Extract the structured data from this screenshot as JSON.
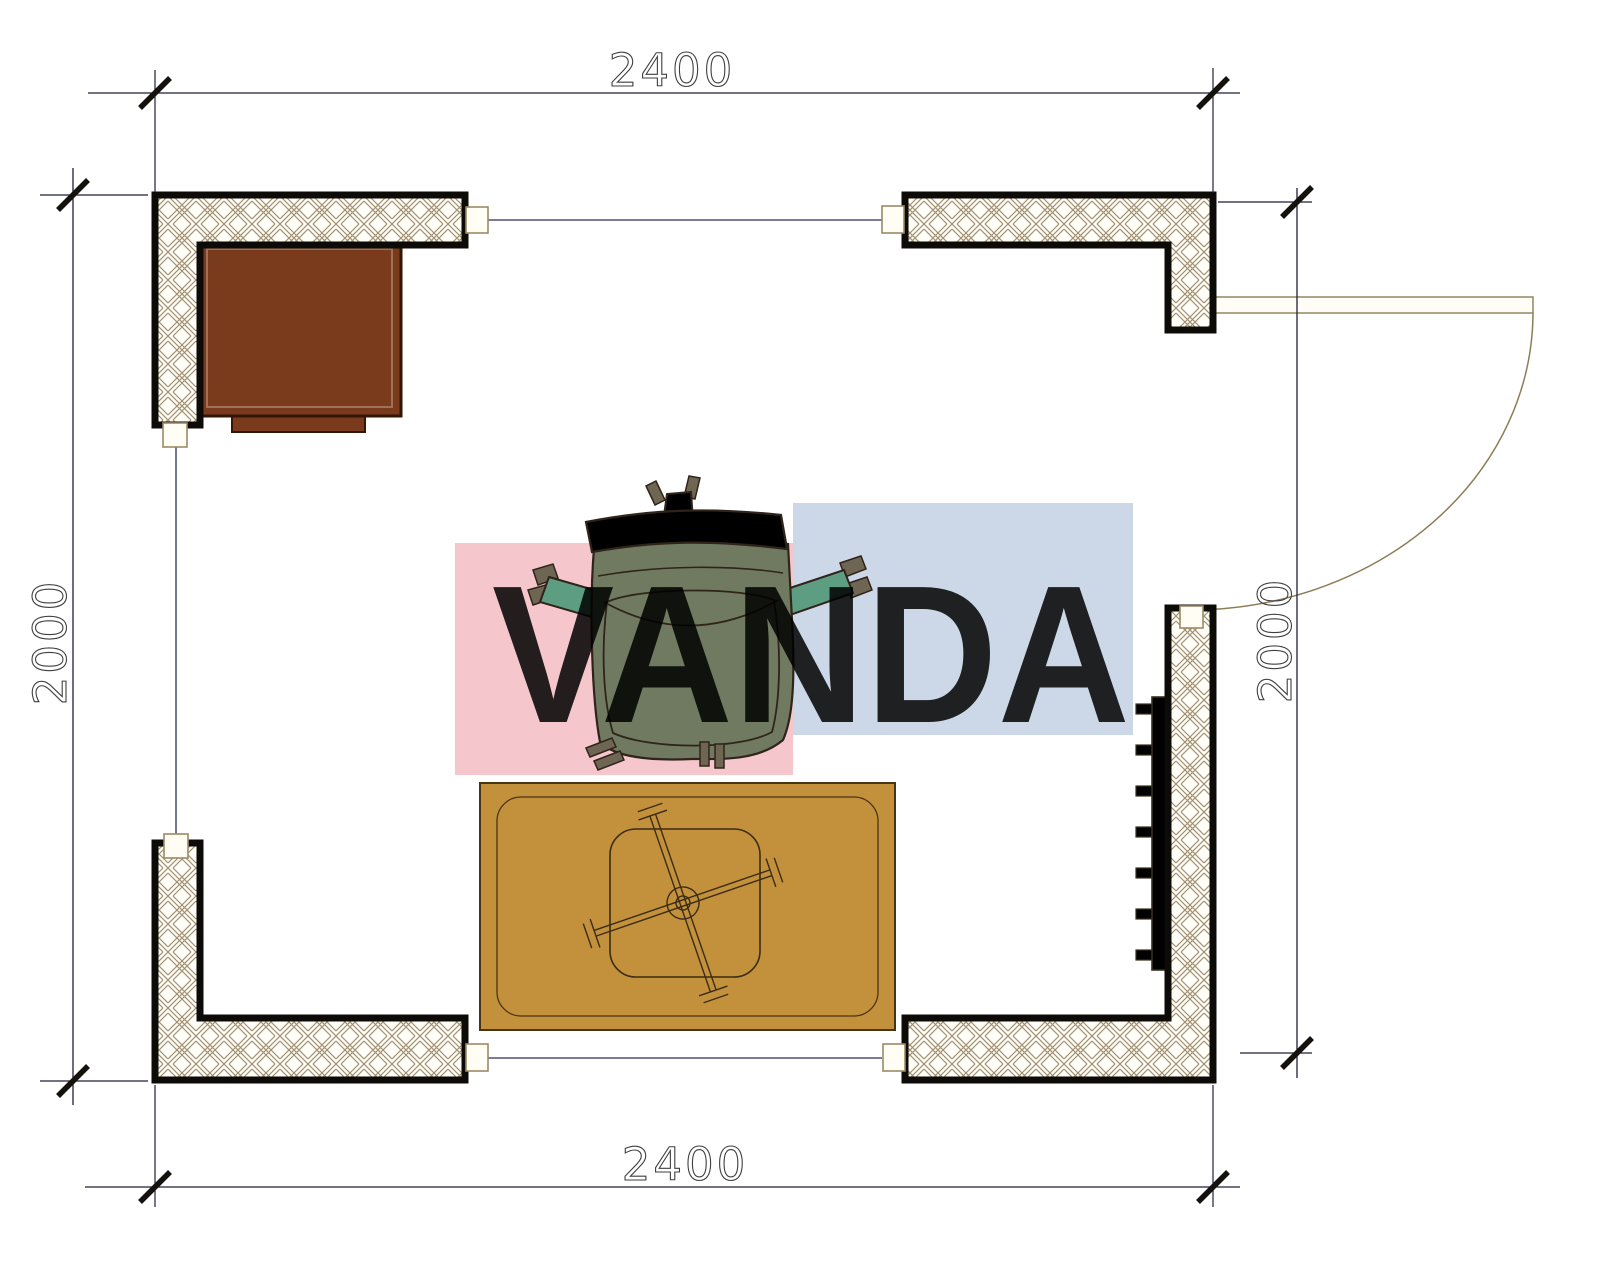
{
  "dimensions": {
    "top": "2400",
    "bottom": "2400",
    "left": "2000",
    "right": "2000"
  },
  "watermark": {
    "text": "VANDA",
    "pink_block": "#f5c7cd",
    "blue_block": "#ccd8e8",
    "text_color": "#ffffff"
  },
  "colors": {
    "wall_stroke": "#0d0b08",
    "hatch_line": "#a29070",
    "hatch_bg": "#fefdf8",
    "dim_line": "#1f1f3a",
    "connector": "#2b2b5e",
    "door": "#8d7d57",
    "cabinet_fill": "#7a3b1d",
    "cabinet_stroke": "#331606",
    "rug_fill": "#c3913c",
    "rug_stroke": "#4a3416",
    "chair_seat": "#6f7a60",
    "chair_back": "#5d9d82",
    "chair_outline": "#30241a",
    "chair_dark": "#6e6553",
    "radiator_fill": "#6b5b39",
    "radiator_stroke": "#3a2f1a"
  }
}
